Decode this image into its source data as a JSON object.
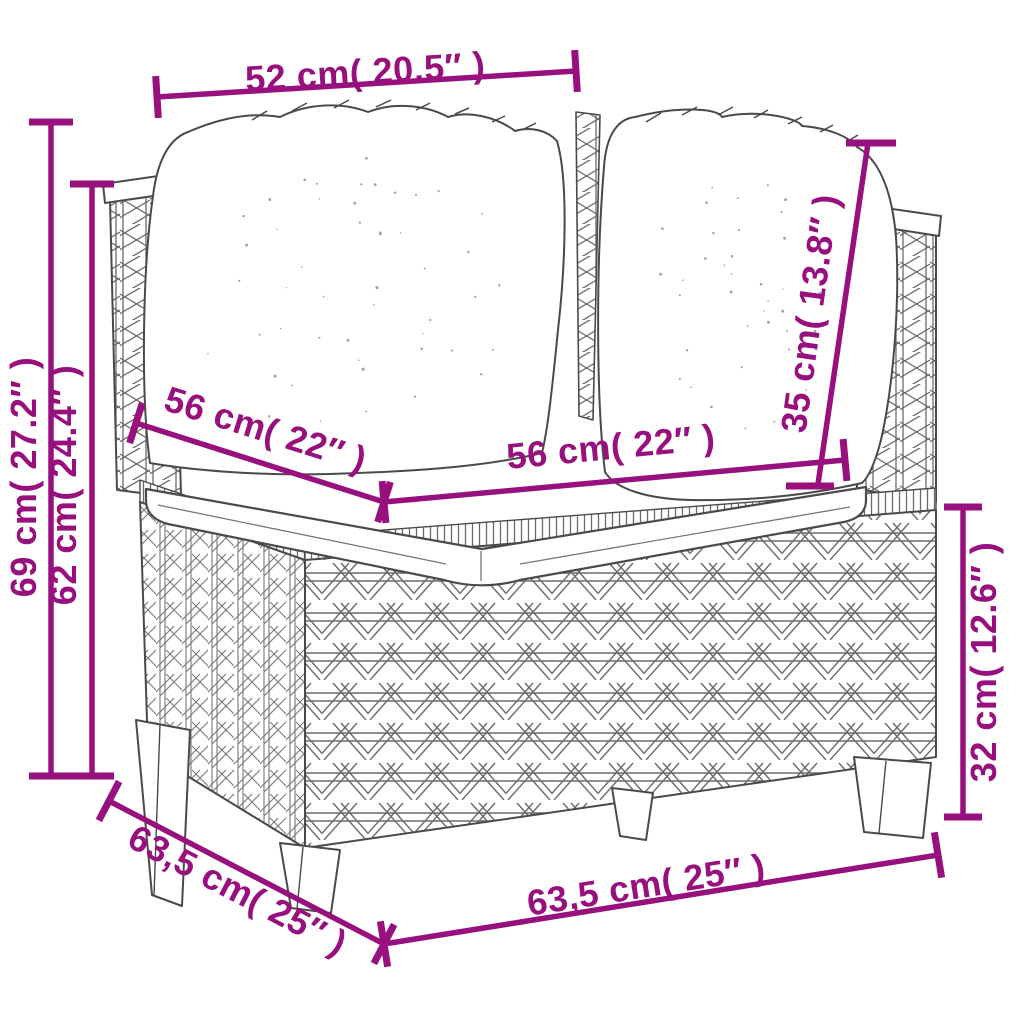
{
  "figure": {
    "kind": "product-dimension-diagram",
    "subject": "poly rattan corner sofa with back cushions and seat cushion"
  },
  "colors": {
    "dimension_accent": "#98107E",
    "sketch_line": "#4A4A4A",
    "sketch_light": "#6B6B6B",
    "background": "#FFFFFF"
  },
  "dimensions": [
    {
      "id": "top-width",
      "label": "52 cm( 20.5″ )"
    },
    {
      "id": "height-total",
      "label": "69 cm( 27.2″ )"
    },
    {
      "id": "height-arm",
      "label": "62 cm( 24.4″ )"
    },
    {
      "id": "seat-depth",
      "label": "56 cm( 22″ )"
    },
    {
      "id": "seat-width",
      "label": "56 cm( 22″ )"
    },
    {
      "id": "back-cushion-height",
      "label": "35 cm( 13.8″ )"
    },
    {
      "id": "base-height",
      "label": "32 cm( 12.6″ )"
    },
    {
      "id": "depth-total",
      "label": "63,5 cm( 25″ )"
    },
    {
      "id": "width-total",
      "label": "63,5 cm( 25″ )"
    }
  ]
}
